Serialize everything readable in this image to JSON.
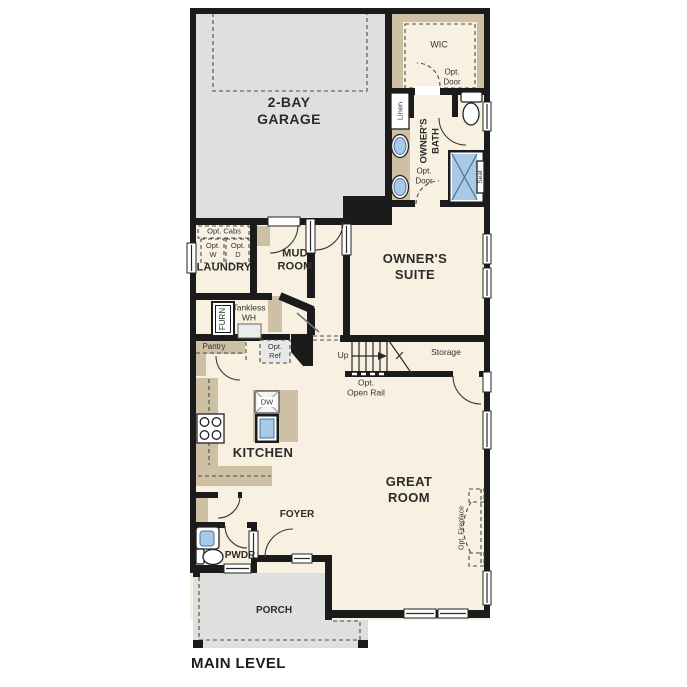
{
  "plan": {
    "title": "MAIN LEVEL",
    "colors": {
      "wall": "#1b1b1b",
      "floor": "#f8f1e2",
      "concrete": "#dfdfde",
      "cabinet": "#cec0a5",
      "fixture_blue": "#a9c9e5"
    },
    "rooms": {
      "garage": {
        "line1": "2-BAY",
        "line2": "GARAGE"
      },
      "wic": {
        "label": "WIC"
      },
      "owners_bath": {
        "line1": "OWNER'S",
        "line2": "BATH"
      },
      "owners_suite": {
        "line1": "OWNER'S",
        "line2": "SUITE"
      },
      "laundry": {
        "label": "LAUNDRY"
      },
      "mud_room": {
        "line1": "MUD",
        "line2": "ROOM"
      },
      "kitchen": {
        "label": "KITCHEN"
      },
      "great_room": {
        "line1": "GREAT",
        "line2": "ROOM"
      },
      "foyer": {
        "label": "FOYER"
      },
      "powder": {
        "label": "PWDR"
      },
      "porch": {
        "label": "PORCH"
      }
    },
    "annotations": {
      "wic_opt_door": {
        "line1": "Opt.",
        "line2": "Door"
      },
      "bath_opt_door": {
        "line1": "Opt.",
        "line2": "Door"
      },
      "linen": "Linen",
      "seat": "Seat",
      "opt_cabs": "Opt. Cabs",
      "opt_washer": {
        "line1": "Opt.",
        "line2": "W"
      },
      "opt_dryer": {
        "line1": "Opt.",
        "line2": "D"
      },
      "furnace": "FURN",
      "tankless": {
        "line1": "Tankless",
        "line2": "WH"
      },
      "pantry": "Pantry",
      "opt_ref": {
        "line1": "Opt.",
        "line2": "Ref"
      },
      "stairs_up": "Up",
      "storage": "Storage",
      "opt_open_rail": {
        "line1": "Opt.",
        "line2": "Open Rail"
      },
      "dishwasher": "DW",
      "opt_fireplace": "Opt. Fireplace"
    }
  }
}
